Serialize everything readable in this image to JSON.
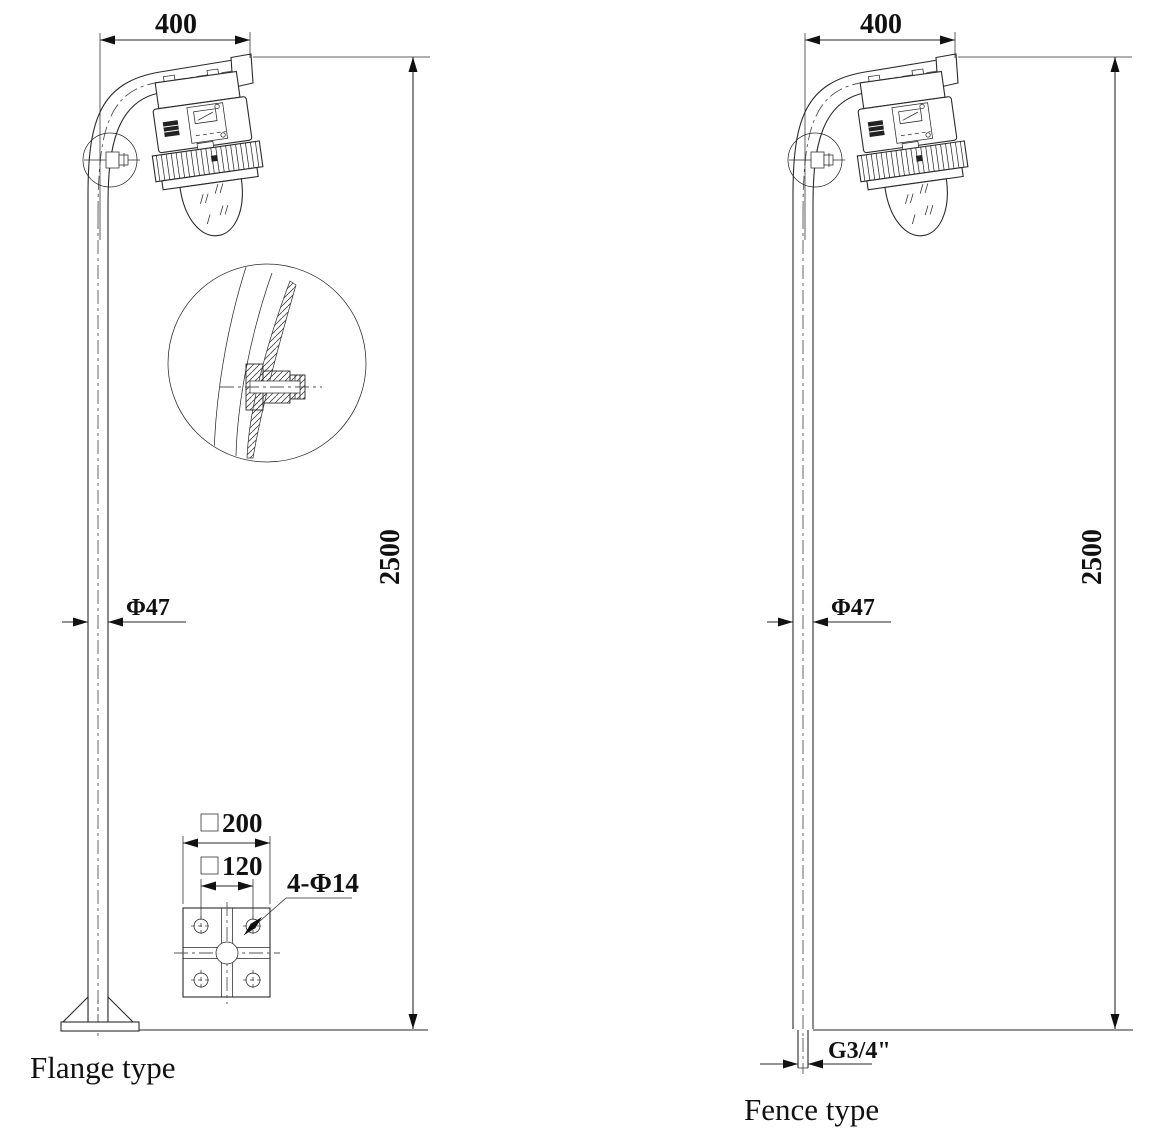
{
  "colors": {
    "line": "#2a2a2a",
    "text": "#111111",
    "background": "#ffffff"
  },
  "figures": {
    "flange": {
      "label": "Flange type",
      "dims": {
        "arm_reach": "400",
        "height": "2500",
        "pole_diameter": "Φ47"
      },
      "base_plate": {
        "outer_size": "200",
        "bolt_spacing": "120",
        "holes": "4-Φ14"
      }
    },
    "fence": {
      "label": "Fence type",
      "dims": {
        "arm_reach": "400",
        "height": "2500",
        "pole_diameter": "Φ47",
        "thread": "G3/4\""
      }
    }
  }
}
